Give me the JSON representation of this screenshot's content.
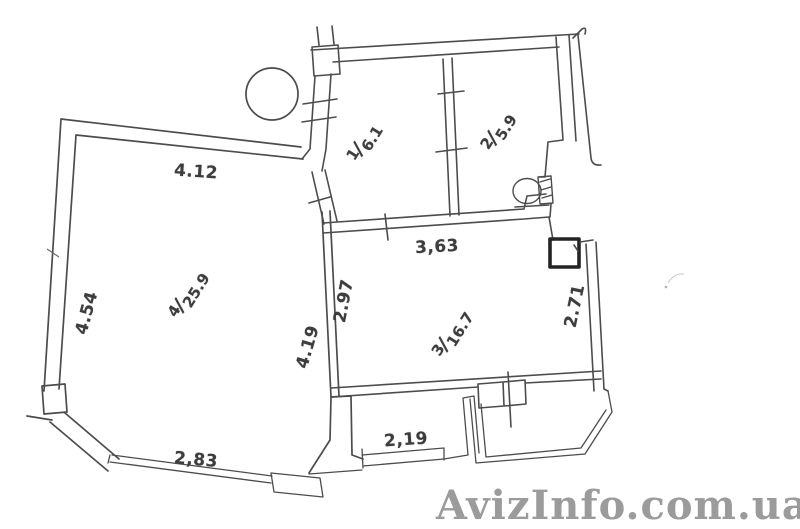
{
  "watermark": "AvizInfo.com.ua",
  "rooms": {
    "r1": {
      "number": "1",
      "area": "6.1"
    },
    "r2": {
      "number": "2",
      "area": "5.9"
    },
    "r3": {
      "number": "3",
      "area": "16.7"
    },
    "r4": {
      "number": "4",
      "area": "25.9"
    }
  },
  "fraction_separator": "/",
  "dimensions": {
    "room4_top": "4.12",
    "room4_left": "4.54",
    "room4_right": "4.19",
    "room3_top": "3,63",
    "room3_left": "2.97",
    "room3_right": "2.71",
    "bay_window": "2,83",
    "niche_window": "2,19"
  },
  "fixture_icons": {
    "column": "round-column-icon",
    "toilet": "toilet-icon",
    "vent_shaft": "vent-shaft-icon"
  },
  "colors": {
    "wall_line": "#4c4c4c",
    "dimension_text": "#3d3d3d",
    "watermark": "#9b9b9b",
    "background": "#ffffff"
  }
}
